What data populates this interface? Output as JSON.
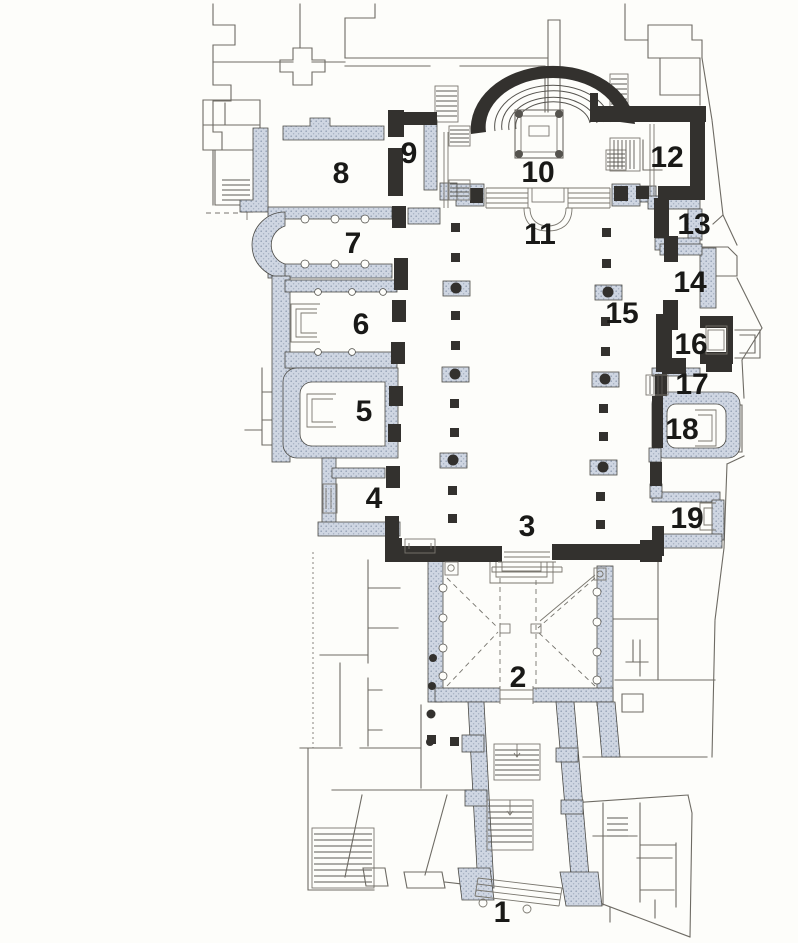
{
  "figure": {
    "kind": "architectural-floor-plan",
    "description": "Scanned basilica ground plan with numbered spaces"
  },
  "colors": {
    "background": "#fdfdfa",
    "ancient_wall_dark": "#33312e",
    "later_wall_light_blue": "#cfd6e2",
    "outline_gray": "#6e6b64",
    "label_color": "#191917"
  },
  "rooms": [
    {
      "n": "1",
      "x": 502,
      "y": 922
    },
    {
      "n": "2",
      "x": 518,
      "y": 687
    },
    {
      "n": "3",
      "x": 527,
      "y": 536
    },
    {
      "n": "4",
      "x": 374,
      "y": 508
    },
    {
      "n": "5",
      "x": 364,
      "y": 421
    },
    {
      "n": "6",
      "x": 361,
      "y": 334
    },
    {
      "n": "7",
      "x": 353,
      "y": 253
    },
    {
      "n": "8",
      "x": 341,
      "y": 183
    },
    {
      "n": "9",
      "x": 409,
      "y": 163
    },
    {
      "n": "10",
      "x": 538,
      "y": 182
    },
    {
      "n": "11",
      "x": 540,
      "y": 244
    },
    {
      "n": "12",
      "x": 667,
      "y": 167
    },
    {
      "n": "13",
      "x": 694,
      "y": 234
    },
    {
      "n": "14",
      "x": 690,
      "y": 292
    },
    {
      "n": "15",
      "x": 622,
      "y": 323
    },
    {
      "n": "16",
      "x": 691,
      "y": 354
    },
    {
      "n": "17",
      "x": 692,
      "y": 394
    },
    {
      "n": "18",
      "x": 682,
      "y": 439
    },
    {
      "n": "19",
      "x": 687,
      "y": 528
    }
  ]
}
